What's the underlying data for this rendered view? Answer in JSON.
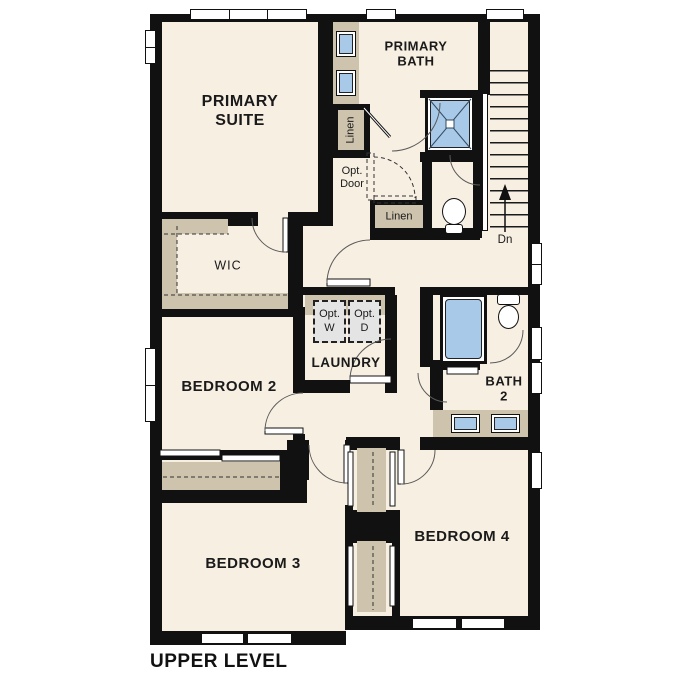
{
  "page_title": "UPPER LEVEL",
  "colors": {
    "wall": "#111111",
    "floor": "#f7efe2",
    "cabinet": "#cec3ad",
    "fixture": "#a9c9e8",
    "appliance": "#e4e4e4"
  },
  "rooms": {
    "primary_suite": {
      "line1": "PRIMARY",
      "line2": "SUITE"
    },
    "primary_bath": {
      "line1": "PRIMARY",
      "line2": "BATH"
    },
    "wic": {
      "label": "WIC"
    },
    "bedroom2": {
      "label": "BEDROOM 2"
    },
    "laundry": {
      "label": "LAUNDRY"
    },
    "bath2": {
      "line1": "BATH",
      "line2": "2"
    },
    "bedroom3": {
      "label": "BEDROOM 3"
    },
    "bedroom4": {
      "label": "BEDROOM 4"
    }
  },
  "annotations": {
    "linen_upper": "Linen",
    "linen_lower": "Linen",
    "opt_door": {
      "line1": "Opt.",
      "line2": "Door"
    },
    "opt_washer": {
      "line1": "Opt.",
      "line2": "W"
    },
    "opt_dryer": {
      "line1": "Opt.",
      "line2": "D"
    },
    "stairs_down": "Dn"
  }
}
